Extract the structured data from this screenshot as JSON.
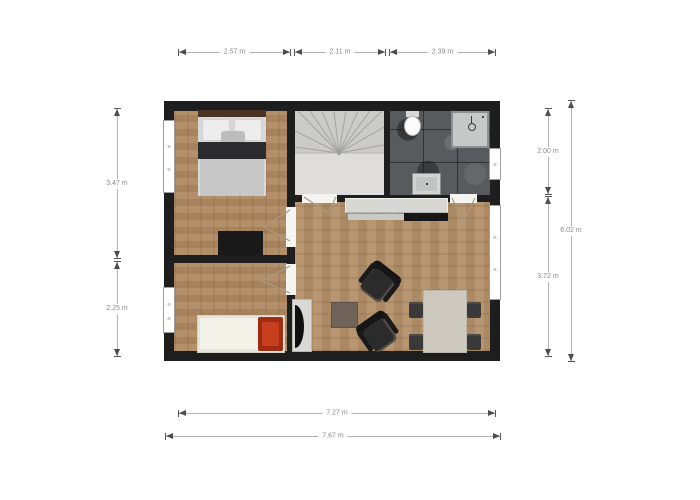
{
  "title": "floor-plan",
  "palette": {
    "wall": "#1e1e1e",
    "wood_floor": "#b08a62",
    "stair_floor": "#dadad8",
    "bathroom_floor": "#585b5d",
    "counter": "#d7d7d4",
    "dining_table": "#cdc9be",
    "accent_red_pillow": "#c73f1f",
    "dimension_line": "#b3b3b3",
    "dimension_text": "#8a8a8a"
  },
  "dimensions": {
    "top": [
      {
        "label": "2.57 m"
      },
      {
        "label": "2.11 m"
      },
      {
        "label": "2.39 m"
      }
    ],
    "left": [
      {
        "label": "3.47 m"
      },
      {
        "label": "2.25 m"
      }
    ],
    "right": [
      {
        "label": "2.00 m"
      },
      {
        "label": "3.72 m"
      },
      {
        "label": "6.02 m"
      }
    ],
    "bottom": [
      {
        "label": "7.27 m"
      },
      {
        "label": "7.67 m"
      }
    ]
  }
}
